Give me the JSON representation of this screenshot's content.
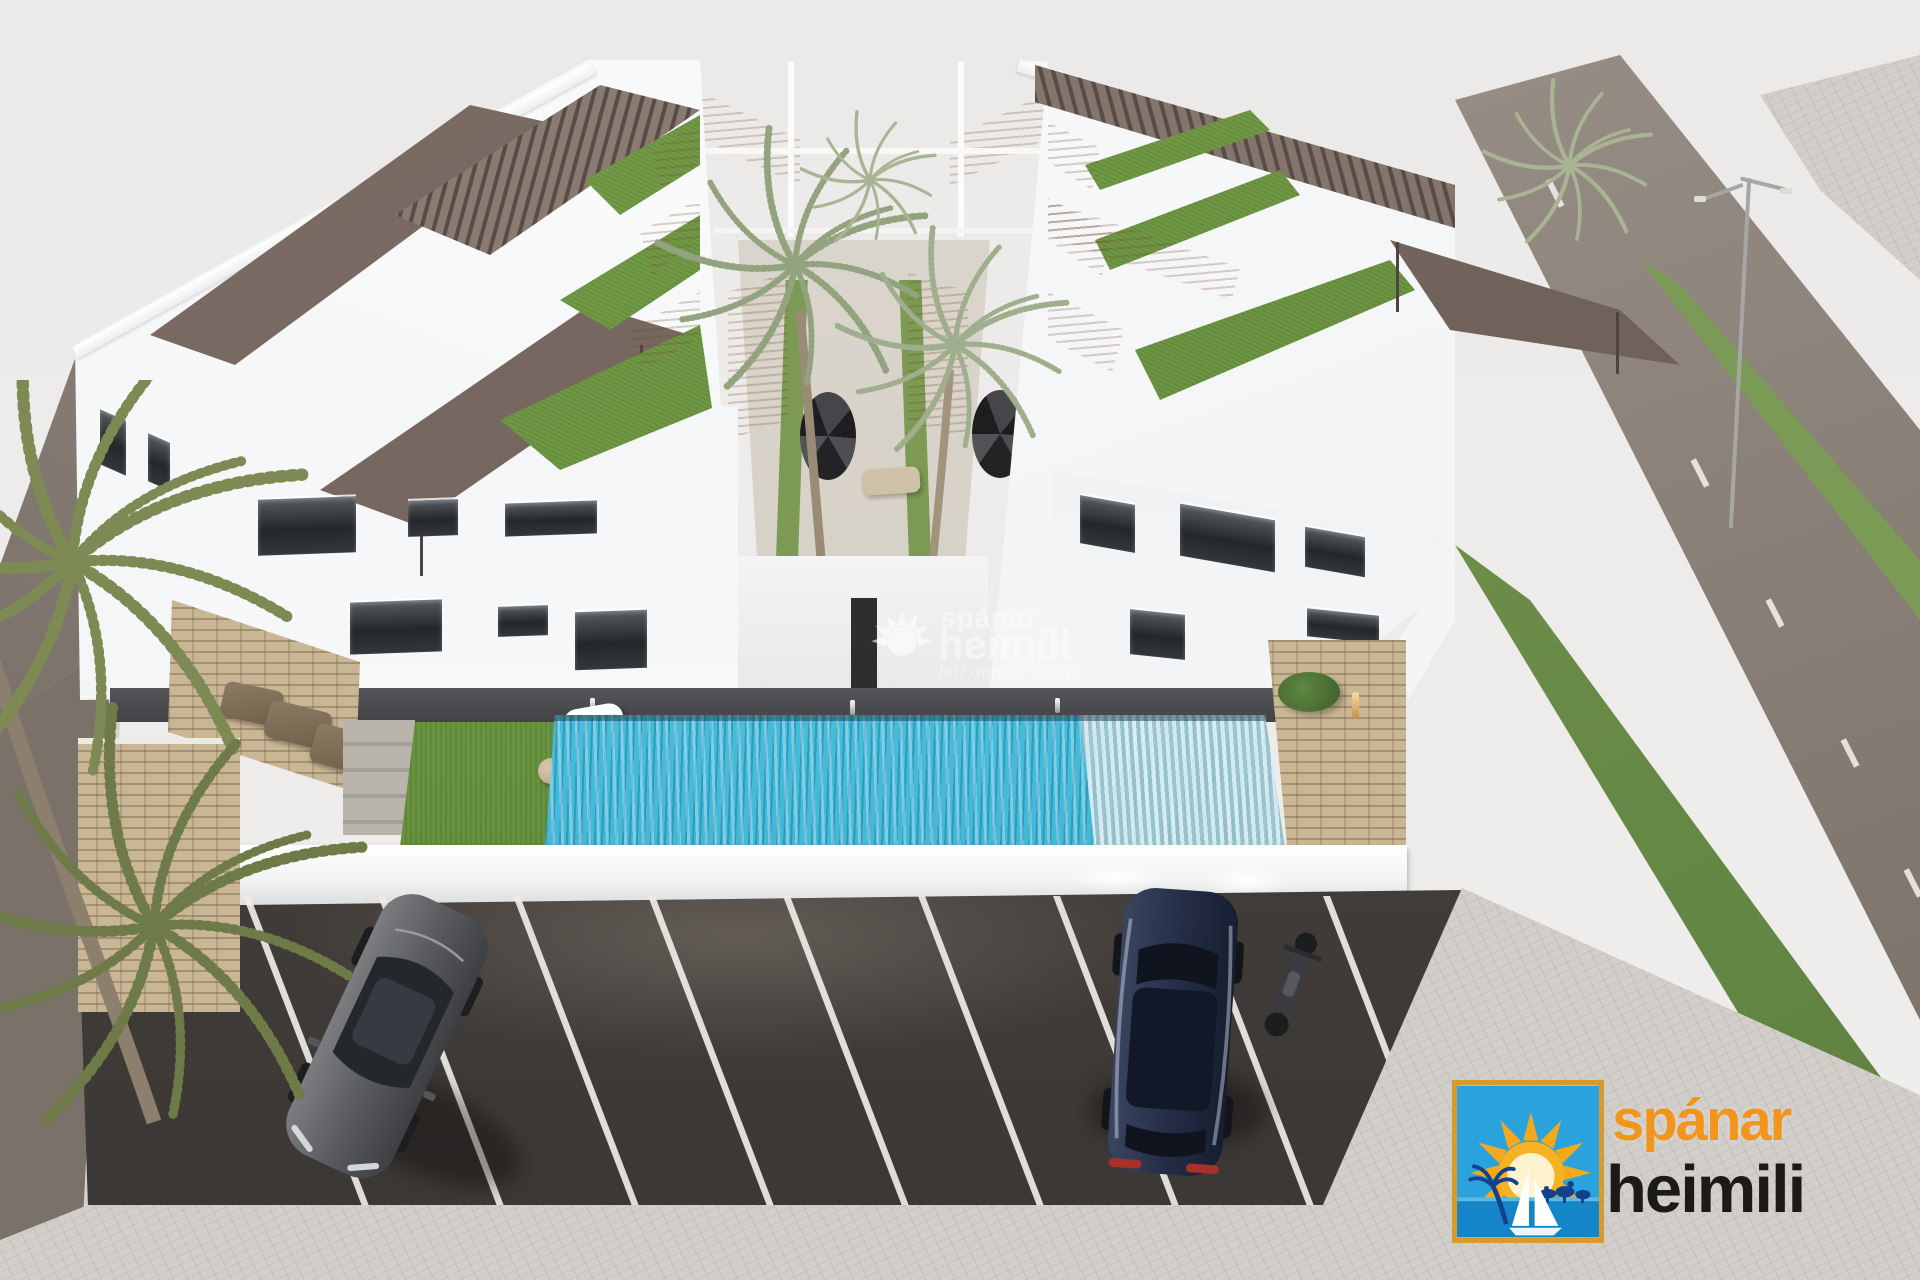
{
  "watermark": {
    "icon": "sun-rays-icon",
    "brand_top": "spánar",
    "brand_bottom": "heimili",
    "tagline": "þitt annað heimili"
  },
  "logo": {
    "icon": "sun-beach-sailboat-icon",
    "brand_top": "spánar",
    "brand_bottom": "heimili",
    "colors": {
      "brand_top": "#f1951d",
      "brand_bottom": "#1b1a18",
      "box_border": "#d89a2e",
      "box_sky": "#2aa3dc",
      "box_sun": "#f4a81d",
      "box_sea": "#1486c8"
    }
  },
  "scene": {
    "description": "Aerial 3D architectural rendering of two white apartment buildings with rooftop terraces and pergolas, a central palm courtyard, communal swimming pool, garden and parking lot",
    "palette": {
      "sky": "#eceae8",
      "building_white": "#f8f9fa",
      "pergola_brown": "#6f6058",
      "roof_lawn_green": "#6d9747",
      "terracotta": "#c68e66",
      "pool_water": "#45bede",
      "asphalt": "#46413d",
      "parking_line": "#efece6",
      "garden_lawn": "#69993f",
      "stone_wall": "#c9b694",
      "road": "#8b8178"
    },
    "counts": {
      "buildings": 2,
      "parked_cars": 2,
      "motorcycles": 1,
      "pools": 1
    }
  }
}
